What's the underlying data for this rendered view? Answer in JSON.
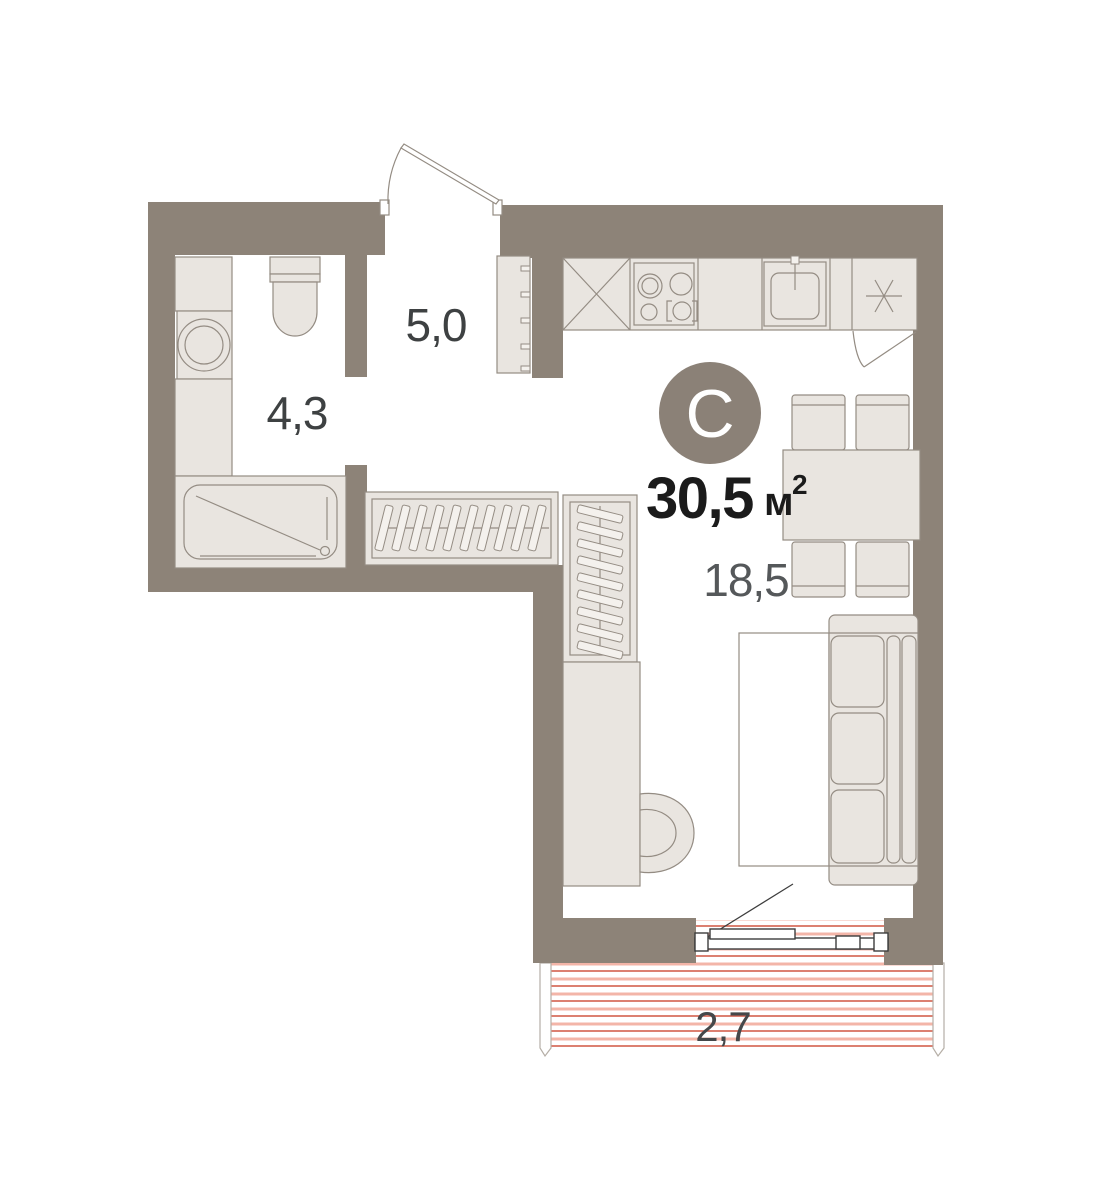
{
  "plan": {
    "type_letter": "С",
    "total_area": {
      "value": "30,5",
      "unit": "м",
      "sup": "2"
    },
    "rooms": {
      "hallway": {
        "area": "5,0"
      },
      "bathroom": {
        "area": "4,3"
      },
      "living": {
        "area": "18,5"
      },
      "balcony": {
        "area": "2,7"
      }
    },
    "icons": {
      "boiler": "asterisk-icon",
      "kitchen_fridge": "cross-box-icon"
    },
    "colors": {
      "wall": "#8d8378",
      "furniture_fill": "#e9e5e0",
      "furniture_stroke": "#948c83",
      "type_circle": "#8b8177",
      "area_text": "#1b1b1b",
      "room_text": "#3e4142",
      "balcony_hatch_strong": "#d4604d",
      "balcony_hatch_light": "#f3b5a8",
      "background": "#ffffff"
    }
  }
}
